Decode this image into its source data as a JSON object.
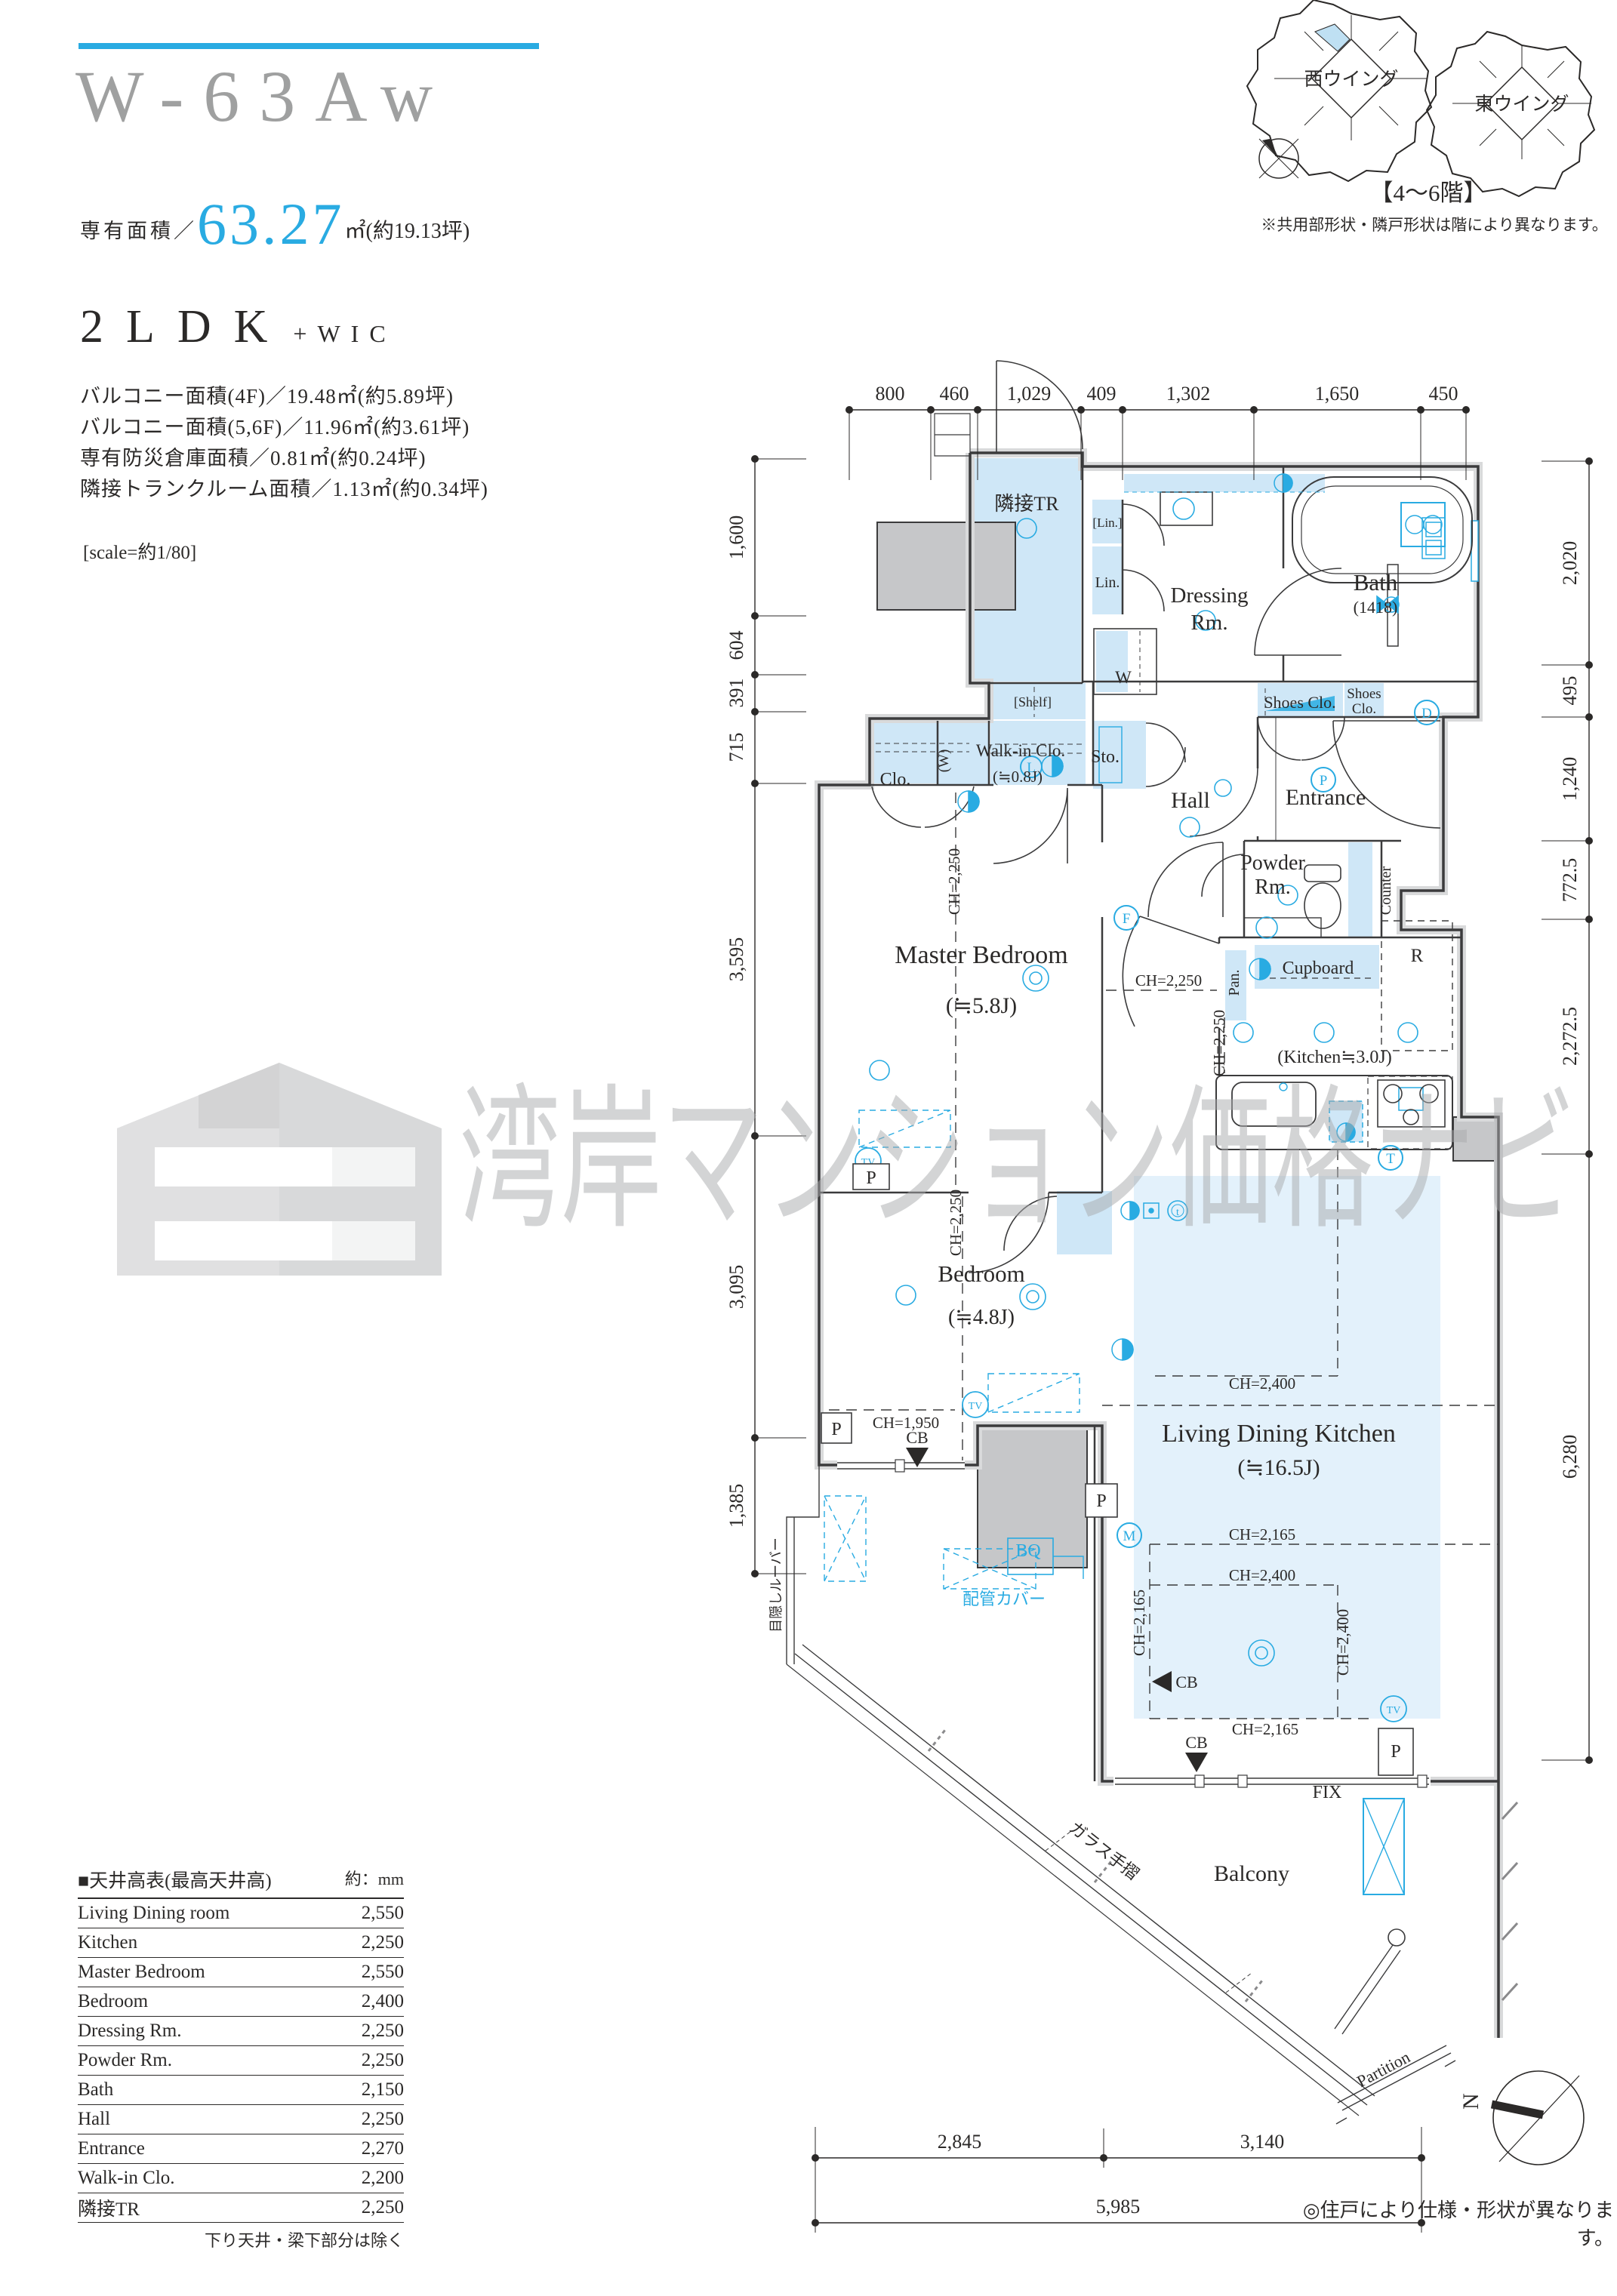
{
  "header": {
    "title": "W-63Aw",
    "area_label": "専有面積／",
    "area_value": "63.27",
    "area_unit": "㎡(約19.13坪)",
    "type": "2LDK",
    "type_suffix": "+WIC",
    "balcony_line1": "バルコニー面積(4F)／19.48㎡(約5.89坪)",
    "balcony_line2": "バルコニー面積(5,6F)／11.96㎡(約3.61坪)",
    "balcony_line3": "専有防災倉庫面積／0.81㎡(約0.24坪)",
    "balcony_line4": "隣接トランクルーム面積／1.13㎡(約0.34坪)",
    "scale_note": "[scale=約1/80]"
  },
  "wings": {
    "west_label": "西ウイング",
    "east_label": "東ウイング",
    "floors": "【4〜6階】",
    "note": "※共用部形状・隣戸形状は階により異なります。",
    "north": "N"
  },
  "plan": {
    "rooms": {
      "adj_tr": "隣接TR",
      "lin_small": "[Lin.]",
      "lin": "Lin.",
      "dressing1": "Dressing",
      "dressing2": "Rm.",
      "bath": "Bath",
      "bath_size": "(1418)",
      "shoes1": "Shoes Clo.",
      "shoes2a": "Shoes",
      "shoes2b": "Clo.",
      "shelf": "[Shelf]",
      "wic": "Walk-in Clo.",
      "wic_size": "(≒0.8J)",
      "w_paren": "(W)",
      "w": "W",
      "clo": "Clo.",
      "sto": "Sto.",
      "hall": "Hall",
      "entrance": "Entrance",
      "powder1": "Powder",
      "powder2": "Rm.",
      "counter": "Counter",
      "master": "Master Bedroom",
      "master_size": "(≒5.8J)",
      "pan": "Pan.",
      "cupboard": "Cupboard",
      "r": "R",
      "kitchen": "(Kitchen≒3.0J)",
      "bedroom": "Bedroom",
      "bedroom_size": "(≒4.8J)",
      "ldk": "Living Dining Kitchen",
      "ldk_size": "(≒16.5J)",
      "balcony": "Balcony"
    },
    "ch": {
      "c2250": "CH=2,250",
      "c2400": "CH=2,400",
      "c2165": "CH=2,165",
      "c1950": "CH=1,950"
    },
    "marks": {
      "p": "P",
      "d": "D",
      "l": "L",
      "f": "F",
      "m": "M",
      "t_up": "T",
      "t_low": "t",
      "tv": "TV",
      "cb": "CB",
      "bq": "BQ",
      "fix": "FIX",
      "partition": "Partition",
      "glass": "ガラス手摺",
      "louver": "目隠しルーバー",
      "pipe_cover": "配管カバー"
    },
    "dims": {
      "top": [
        "800",
        "460",
        "1,029",
        "409",
        "1,302",
        "1,650",
        "450"
      ],
      "left": [
        "1,600",
        "604",
        "391",
        "715",
        "3,595",
        "3,095",
        "1,385"
      ],
      "right": [
        "2,020",
        "495",
        "1,240",
        "772.5",
        "2,272.5",
        "6,280"
      ],
      "bottom": [
        "2,845",
        "3,140",
        "5,985"
      ]
    }
  },
  "watermark": {
    "text": "湾岸マンション価格ナビ"
  },
  "table": {
    "title": "■天井高表(最高天井高)",
    "unit": "約：mm",
    "rows": [
      {
        "label": "Living Dining room",
        "value": "2,550"
      },
      {
        "label": "Kitchen",
        "value": "2,250"
      },
      {
        "label": "Master Bedroom",
        "value": "2,550"
      },
      {
        "label": "Bedroom",
        "value": "2,400"
      },
      {
        "label": "Dressing Rm.",
        "value": "2,250"
      },
      {
        "label": "Powder Rm.",
        "value": "2,250"
      },
      {
        "label": "Bath",
        "value": "2,150"
      },
      {
        "label": "Hall",
        "value": "2,250"
      },
      {
        "label": "Entrance",
        "value": "2,270"
      },
      {
        "label": "Walk-in Clo.",
        "value": "2,200"
      },
      {
        "label": "隣接TR",
        "value": "2,250"
      }
    ],
    "footnote": "下り天井・梁下部分は除く"
  },
  "footer": {
    "note": "◎住戸により仕様・形状が異なります。"
  },
  "colors": {
    "accent": "#29abe2",
    "room_fill": "#cfe7f7",
    "ldk_tint": "#dceefa",
    "wall": "#3b3b3c",
    "concrete": "#c6c7c9",
    "title_gray": "#9fa0a0"
  }
}
